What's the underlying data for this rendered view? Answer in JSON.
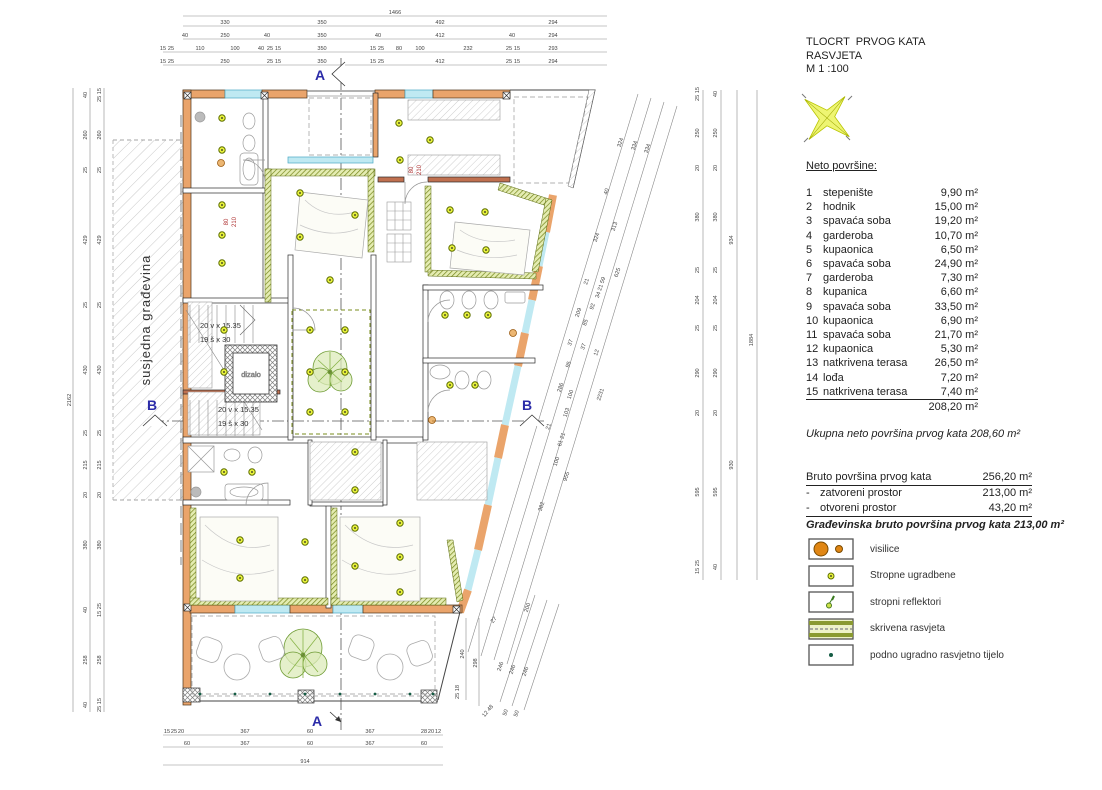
{
  "title_block": {
    "line1": "TLOCRT  PRVOG KATA",
    "line2": "RASVJETA",
    "line3": "M 1 :100"
  },
  "areas": {
    "heading": "Neto površine:",
    "rows": [
      {
        "num": "1",
        "name": "stepenište",
        "area": "9,90 m²"
      },
      {
        "num": "2",
        "name": "hodnik",
        "area": "15,00 m²"
      },
      {
        "num": "3",
        "name": "spavaća soba",
        "area": "19,20 m²"
      },
      {
        "num": "4",
        "name": "garderoba",
        "area": "10,70 m²"
      },
      {
        "num": "5",
        "name": "kupaonica",
        "area": "6,50 m²"
      },
      {
        "num": "6",
        "name": "spavaća soba",
        "area": "24,90 m²"
      },
      {
        "num": "7",
        "name": "garderoba",
        "area": "7,30 m²"
      },
      {
        "num": "8",
        "name": "kupanica",
        "area": "6,60 m²"
      },
      {
        "num": "9",
        "name": "spavaća soba",
        "area": "33,50 m²"
      },
      {
        "num": "10",
        "name": "kupaonica",
        "area": "6,90 m²"
      },
      {
        "num": "11",
        "name": "spavaća soba",
        "area": "21,70 m²"
      },
      {
        "num": "12",
        "name": "kupaonica",
        "area": "5,30 m²"
      },
      {
        "num": "13",
        "name": "natkrivena terasa",
        "area": "26,50 m²"
      },
      {
        "num": "14",
        "name": "lođa",
        "area": "7,20 m²"
      },
      {
        "num": "15",
        "name": "natkrivena terasa",
        "area": "7,40 m²"
      }
    ],
    "total": "208,20 m²"
  },
  "summary": {
    "ukupna": "Ukupna neto površina  prvog kata  208,60 m²",
    "bruto_label": "Bruto površina prvog kata",
    "bruto_value": "256,20 m²",
    "dash": "-",
    "zatvoreni_label": "zatvoreni prostor",
    "zatvoreni_value": "213,00 m²",
    "otvoreni_label": "otvoreni prostor",
    "otvoreni_value": "43,20 m²",
    "gradjevinska": "Građevinska bruto površina prvog kata  213,00 m²"
  },
  "legend": {
    "items": [
      {
        "icon": "pendant-lights-icon",
        "label": "visilice"
      },
      {
        "icon": "ceiling-recessed-light-icon",
        "label": "Stropne ugradbene"
      },
      {
        "icon": "ceiling-spotlight-icon",
        "label": "stropni reflektori"
      },
      {
        "icon": "hidden-lighting-icon",
        "label": "skrivena rasvjeta"
      },
      {
        "icon": "floor-recessed-light-icon",
        "label": "podno ugradno rasvjetno tijelo"
      }
    ]
  },
  "colors": {
    "wall_orange": "#eaa46b",
    "window_cyan": "#bfe9f2",
    "hidden_light_green": "#76861c",
    "light_dot": "#e8f23c",
    "section_blue": "#2b2ba8",
    "door_label_red": "#b03434",
    "pendant_orange": "#e08614"
  },
  "plan": {
    "neighbor_label": "susjedna građevina",
    "elevator_label": "dizalo",
    "stair_label_1": "20 v x 15.35",
    "stair_label_2": "19 š x 30",
    "section_a": "A",
    "section_b": "B",
    "dim_labels": [
      {
        "t": "1466",
        "x": 395,
        "y": 14
      },
      {
        "t": "330",
        "x": 225,
        "y": 24
      },
      {
        "t": "350",
        "x": 322,
        "y": 24
      },
      {
        "t": "492",
        "x": 440,
        "y": 24
      },
      {
        "t": "294",
        "x": 553,
        "y": 24
      },
      {
        "t": "40",
        "x": 185,
        "y": 37
      },
      {
        "t": "250",
        "x": 225,
        "y": 37
      },
      {
        "t": "40",
        "x": 267,
        "y": 37
      },
      {
        "t": "350",
        "x": 322,
        "y": 37
      },
      {
        "t": "40",
        "x": 378,
        "y": 37
      },
      {
        "t": "412",
        "x": 440,
        "y": 37
      },
      {
        "t": "40",
        "x": 512,
        "y": 37
      },
      {
        "t": "294",
        "x": 553,
        "y": 37
      },
      {
        "t": "15",
        "x": 163,
        "y": 50
      },
      {
        "t": "25",
        "x": 171,
        "y": 50
      },
      {
        "t": "110",
        "x": 200,
        "y": 50
      },
      {
        "t": "100",
        "x": 235,
        "y": 50
      },
      {
        "t": "40",
        "x": 261,
        "y": 50
      },
      {
        "t": "25",
        "x": 270,
        "y": 50
      },
      {
        "t": "15",
        "x": 278,
        "y": 50
      },
      {
        "t": "350",
        "x": 322,
        "y": 50
      },
      {
        "t": "15",
        "x": 373,
        "y": 50
      },
      {
        "t": "25",
        "x": 381,
        "y": 50
      },
      {
        "t": "80",
        "x": 399,
        "y": 50
      },
      {
        "t": "100",
        "x": 420,
        "y": 50
      },
      {
        "t": "232",
        "x": 468,
        "y": 50
      },
      {
        "t": "25",
        "x": 509,
        "y": 50
      },
      {
        "t": "15",
        "x": 517,
        "y": 50
      },
      {
        "t": "293",
        "x": 553,
        "y": 50
      },
      {
        "t": "15",
        "x": 163,
        "y": 63
      },
      {
        "t": "25",
        "x": 171,
        "y": 63
      },
      {
        "t": "250",
        "x": 225,
        "y": 63
      },
      {
        "t": "25",
        "x": 270,
        "y": 63
      },
      {
        "t": "15",
        "x": 278,
        "y": 63
      },
      {
        "t": "350",
        "x": 322,
        "y": 63
      },
      {
        "t": "15",
        "x": 373,
        "y": 63
      },
      {
        "t": "25",
        "x": 381,
        "y": 63
      },
      {
        "t": "412",
        "x": 440,
        "y": 63
      },
      {
        "t": "25",
        "x": 509,
        "y": 63
      },
      {
        "t": "15",
        "x": 517,
        "y": 63
      },
      {
        "t": "294",
        "x": 553,
        "y": 63
      },
      {
        "t": "2162",
        "x": 71,
        "y": 400,
        "r": -90
      },
      {
        "t": "40",
        "x": 87,
        "y": 95,
        "r": -90
      },
      {
        "t": "260",
        "x": 87,
        "y": 135,
        "r": -90
      },
      {
        "t": "25",
        "x": 87,
        "y": 170,
        "r": -90
      },
      {
        "t": "429",
        "x": 87,
        "y": 240,
        "r": -90
      },
      {
        "t": "25",
        "x": 87,
        "y": 305,
        "r": -90
      },
      {
        "t": "430",
        "x": 87,
        "y": 370,
        "r": -90
      },
      {
        "t": "25",
        "x": 87,
        "y": 433,
        "r": -90
      },
      {
        "t": "215",
        "x": 87,
        "y": 465,
        "r": -90
      },
      {
        "t": "20",
        "x": 87,
        "y": 495,
        "r": -90
      },
      {
        "t": "380",
        "x": 87,
        "y": 545,
        "r": -90
      },
      {
        "t": "40",
        "x": 87,
        "y": 610,
        "r": -90
      },
      {
        "t": "258",
        "x": 87,
        "y": 660,
        "r": -90
      },
      {
        "t": "40",
        "x": 87,
        "y": 705,
        "r": -90
      },
      {
        "t": "25 15",
        "x": 101,
        "y": 95,
        "r": -90
      },
      {
        "t": "260",
        "x": 101,
        "y": 135,
        "r": -90
      },
      {
        "t": "25",
        "x": 101,
        "y": 170,
        "r": -90
      },
      {
        "t": "429",
        "x": 101,
        "y": 240,
        "r": -90
      },
      {
        "t": "25",
        "x": 101,
        "y": 305,
        "r": -90
      },
      {
        "t": "430",
        "x": 101,
        "y": 370,
        "r": -90
      },
      {
        "t": "25",
        "x": 101,
        "y": 433,
        "r": -90
      },
      {
        "t": "215",
        "x": 101,
        "y": 465,
        "r": -90
      },
      {
        "t": "20",
        "x": 101,
        "y": 495,
        "r": -90
      },
      {
        "t": "380",
        "x": 101,
        "y": 545,
        "r": -90
      },
      {
        "t": "15 25",
        "x": 101,
        "y": 610,
        "r": -90
      },
      {
        "t": "258",
        "x": 101,
        "y": 660,
        "r": -90
      },
      {
        "t": "25 15",
        "x": 101,
        "y": 705,
        "r": -90
      },
      {
        "t": "25 15",
        "x": 699,
        "y": 94,
        "r": -90
      },
      {
        "t": "250",
        "x": 699,
        "y": 133,
        "r": -90
      },
      {
        "t": "20",
        "x": 699,
        "y": 168,
        "r": -90
      },
      {
        "t": "380",
        "x": 699,
        "y": 217,
        "r": -90
      },
      {
        "t": "25",
        "x": 699,
        "y": 270,
        "r": -90
      },
      {
        "t": "204",
        "x": 699,
        "y": 300,
        "r": -90
      },
      {
        "t": "25",
        "x": 699,
        "y": 328,
        "r": -90
      },
      {
        "t": "290",
        "x": 699,
        "y": 373,
        "r": -90
      },
      {
        "t": "20",
        "x": 699,
        "y": 413,
        "r": -90
      },
      {
        "t": "595",
        "x": 699,
        "y": 492,
        "r": -90
      },
      {
        "t": "15 25",
        "x": 699,
        "y": 567,
        "r": -90
      },
      {
        "t": "40",
        "x": 717,
        "y": 94,
        "r": -90
      },
      {
        "t": "250",
        "x": 717,
        "y": 133,
        "r": -90
      },
      {
        "t": "20",
        "x": 717,
        "y": 168,
        "r": -90
      },
      {
        "t": "380",
        "x": 717,
        "y": 217,
        "r": -90
      },
      {
        "t": "25",
        "x": 717,
        "y": 270,
        "r": -90
      },
      {
        "t": "204",
        "x": 717,
        "y": 300,
        "r": -90
      },
      {
        "t": "25",
        "x": 717,
        "y": 328,
        "r": -90
      },
      {
        "t": "290",
        "x": 717,
        "y": 373,
        "r": -90
      },
      {
        "t": "20",
        "x": 717,
        "y": 413,
        "r": -90
      },
      {
        "t": "595",
        "x": 717,
        "y": 492,
        "r": -90
      },
      {
        "t": "40",
        "x": 717,
        "y": 567,
        "r": -90
      },
      {
        "t": "934",
        "x": 733,
        "y": 240,
        "r": -90
      },
      {
        "t": "930",
        "x": 733,
        "y": 465,
        "r": -90
      },
      {
        "t": "1884",
        "x": 753,
        "y": 340,
        "r": -90
      },
      {
        "t": "324",
        "x": 622,
        "y": 143,
        "r": -72
      },
      {
        "t": "334",
        "x": 636,
        "y": 146,
        "r": -72
      },
      {
        "t": "334",
        "x": 649,
        "y": 149,
        "r": -72
      },
      {
        "t": "40",
        "x": 608,
        "y": 192,
        "r": -72
      },
      {
        "t": "313",
        "x": 616,
        "y": 227,
        "r": -72
      },
      {
        "t": "324",
        "x": 598,
        "y": 238,
        "r": -72
      },
      {
        "t": "625",
        "x": 619,
        "y": 273,
        "r": -72
      },
      {
        "t": "21",
        "x": 588,
        "y": 282,
        "r": -72
      },
      {
        "t": "34 21 59",
        "x": 602,
        "y": 288,
        "r": -72
      },
      {
        "t": "92",
        "x": 594,
        "y": 307,
        "r": -72
      },
      {
        "t": "209",
        "x": 580,
        "y": 313,
        "r": -72
      },
      {
        "t": "85",
        "x": 587,
        "y": 323,
        "r": -72
      },
      {
        "t": "37",
        "x": 572,
        "y": 343,
        "r": -72
      },
      {
        "t": "37",
        "x": 585,
        "y": 347,
        "r": -72
      },
      {
        "t": "12",
        "x": 598,
        "y": 353,
        "r": -72
      },
      {
        "t": "95",
        "x": 570,
        "y": 365,
        "r": -72
      },
      {
        "t": "286",
        "x": 562,
        "y": 388,
        "r": -72
      },
      {
        "t": "100",
        "x": 572,
        "y": 395,
        "r": -72
      },
      {
        "t": "2231",
        "x": 602,
        "y": 395,
        "r": -72
      },
      {
        "t": "103",
        "x": 568,
        "y": 413,
        "r": -72
      },
      {
        "t": "21",
        "x": 550,
        "y": 427,
        "r": -72
      },
      {
        "t": "61 21",
        "x": 563,
        "y": 440,
        "r": -72
      },
      {
        "t": "100",
        "x": 558,
        "y": 462,
        "r": -72
      },
      {
        "t": "955",
        "x": 568,
        "y": 477,
        "r": -72
      },
      {
        "t": "382",
        "x": 543,
        "y": 507,
        "r": -72
      },
      {
        "t": "240",
        "x": 464,
        "y": 654,
        "r": -90
      },
      {
        "t": "298",
        "x": 477,
        "y": 663,
        "r": -90
      },
      {
        "t": "25 18",
        "x": 459,
        "y": 692,
        "r": -90
      },
      {
        "t": "12 48",
        "x": 489,
        "y": 712,
        "r": -50
      },
      {
        "t": "200",
        "x": 529,
        "y": 608,
        "r": -72
      },
      {
        "t": "27",
        "x": 495,
        "y": 621,
        "r": -50
      },
      {
        "t": "246",
        "x": 502,
        "y": 667,
        "r": -72
      },
      {
        "t": "246",
        "x": 514,
        "y": 670,
        "r": -72
      },
      {
        "t": "246",
        "x": 527,
        "y": 672,
        "r": -72
      },
      {
        "t": "50",
        "x": 507,
        "y": 713,
        "r": -72
      },
      {
        "t": "50",
        "x": 518,
        "y": 714,
        "r": -72
      },
      {
        "t": "15",
        "x": 167,
        "y": 733
      },
      {
        "t": "25",
        "x": 174,
        "y": 733
      },
      {
        "t": "20",
        "x": 181,
        "y": 733
      },
      {
        "t": "367",
        "x": 245,
        "y": 733
      },
      {
        "t": "60",
        "x": 310,
        "y": 733
      },
      {
        "t": "367",
        "x": 370,
        "y": 733
      },
      {
        "t": "28",
        "x": 424,
        "y": 733
      },
      {
        "t": "20",
        "x": 431,
        "y": 733
      },
      {
        "t": "12",
        "x": 438,
        "y": 733
      },
      {
        "t": "60",
        "x": 187,
        "y": 745
      },
      {
        "t": "367",
        "x": 245,
        "y": 745
      },
      {
        "t": "60",
        "x": 310,
        "y": 745
      },
      {
        "t": "367",
        "x": 370,
        "y": 745
      },
      {
        "t": "60",
        "x": 424,
        "y": 745
      },
      {
        "t": "914",
        "x": 305,
        "y": 763
      },
      {
        "t": "80",
        "x": 413,
        "y": 170,
        "r": -90,
        "c": "red"
      },
      {
        "t": "210",
        "x": 421,
        "y": 170,
        "r": -90,
        "c": "red"
      },
      {
        "t": "80",
        "x": 228,
        "y": 222,
        "r": -90,
        "c": "red"
      },
      {
        "t": "210",
        "x": 236,
        "y": 222,
        "r": -90,
        "c": "red"
      }
    ],
    "lights": [
      [
        222,
        118
      ],
      [
        222,
        150
      ],
      [
        222,
        205
      ],
      [
        222,
        235
      ],
      [
        222,
        263
      ],
      [
        224,
        330
      ],
      [
        224,
        372
      ],
      [
        224,
        472
      ],
      [
        252,
        472
      ],
      [
        240,
        540
      ],
      [
        240,
        578
      ],
      [
        305,
        542
      ],
      [
        305,
        580
      ],
      [
        355,
        452
      ],
      [
        355,
        490
      ],
      [
        355,
        528
      ],
      [
        355,
        566
      ],
      [
        400,
        523
      ],
      [
        400,
        557
      ],
      [
        400,
        592
      ],
      [
        310,
        330
      ],
      [
        345,
        330
      ],
      [
        310,
        372
      ],
      [
        345,
        372
      ],
      [
        310,
        412
      ],
      [
        345,
        412
      ],
      [
        300,
        193
      ],
      [
        300,
        237
      ],
      [
        355,
        215
      ],
      [
        330,
        280
      ],
      [
        399,
        123
      ],
      [
        430,
        140
      ],
      [
        400,
        160
      ],
      [
        450,
        210
      ],
      [
        485,
        212
      ],
      [
        452,
        248
      ],
      [
        486,
        250
      ],
      [
        445,
        315
      ],
      [
        467,
        315
      ],
      [
        488,
        315
      ],
      [
        450,
        385
      ],
      [
        475,
        385
      ]
    ],
    "floor_lights": [
      [
        200,
        694
      ],
      [
        235,
        694
      ],
      [
        270,
        694
      ],
      [
        305,
        694
      ],
      [
        340,
        694
      ],
      [
        375,
        694
      ],
      [
        410,
        694
      ],
      [
        433,
        694
      ]
    ],
    "pendants": [
      [
        221,
        163
      ],
      [
        513,
        333
      ],
      [
        432,
        420
      ]
    ]
  }
}
